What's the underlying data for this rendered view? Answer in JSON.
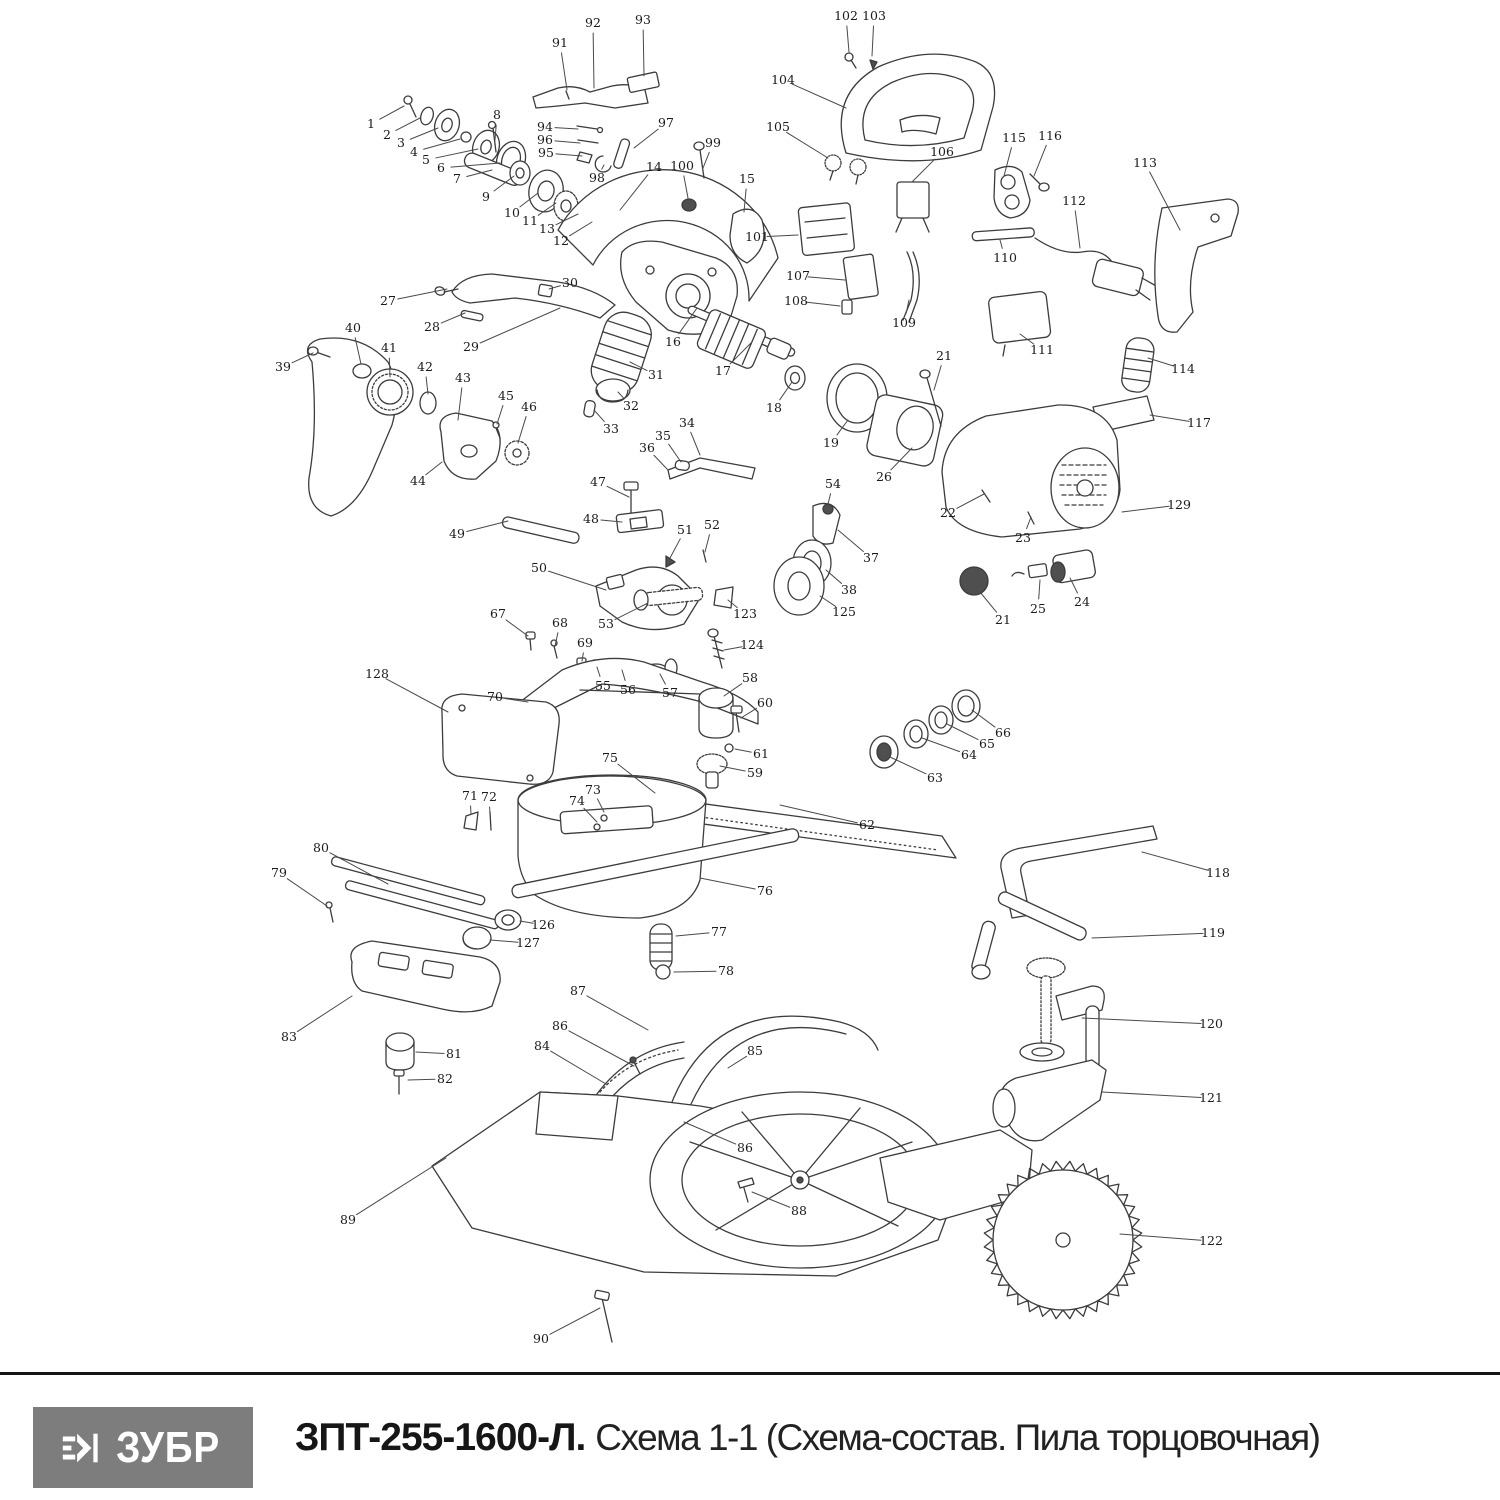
{
  "footer": {
    "logo_text": "ЗУБР",
    "title_bold": "ЗПТ-255-1600-Л.",
    "title_regular": "Схема 1-1 (Схема-состав. Пила торцовочная)"
  },
  "colors": {
    "logo_bg": "#7d7d7d",
    "line": "#3c3c3c",
    "label": "#1b1b1b"
  },
  "diagram": {
    "description": "Exploded-view parts schematic of a miter saw, numbered part labels with leader lines",
    "parts": [
      {
        "n": "1",
        "x": 371,
        "y": 124,
        "tx": 404,
        "ty": 106
      },
      {
        "n": "2",
        "x": 387,
        "y": 135,
        "tx": 420,
        "ty": 118
      },
      {
        "n": "3",
        "x": 401,
        "y": 143,
        "tx": 438,
        "ty": 128
      },
      {
        "n": "4",
        "x": 414,
        "y": 152,
        "tx": 460,
        "ty": 139
      },
      {
        "n": "5",
        "x": 426,
        "y": 160,
        "tx": 478,
        "ty": 149
      },
      {
        "n": "6",
        "x": 441,
        "y": 168,
        "tx": 500,
        "ty": 163
      },
      {
        "n": "7",
        "x": 457,
        "y": 179,
        "tx": 492,
        "ty": 170
      },
      {
        "n": "8",
        "x": 497,
        "y": 115,
        "tx": 495,
        "ty": 140
      },
      {
        "n": "9",
        "x": 486,
        "y": 197,
        "tx": 514,
        "ty": 176
      },
      {
        "n": "10",
        "x": 512,
        "y": 213,
        "tx": 538,
        "ty": 193
      },
      {
        "n": "11",
        "x": 530,
        "y": 221,
        "tx": 556,
        "ty": 203
      },
      {
        "n": "13",
        "x": 547,
        "y": 229,
        "tx": 578,
        "ty": 214
      },
      {
        "n": "12",
        "x": 561,
        "y": 241,
        "tx": 592,
        "ty": 222
      },
      {
        "n": "14",
        "x": 654,
        "y": 167,
        "tx": 620,
        "ty": 210
      },
      {
        "n": "15",
        "x": 747,
        "y": 179,
        "tx": 744,
        "ty": 212
      },
      {
        "n": "16",
        "x": 673,
        "y": 342,
        "tx": 697,
        "ty": 308
      },
      {
        "n": "17",
        "x": 723,
        "y": 371,
        "tx": 752,
        "ty": 342
      },
      {
        "n": "18",
        "x": 774,
        "y": 408,
        "tx": 792,
        "ty": 382
      },
      {
        "n": "19",
        "x": 831,
        "y": 443,
        "tx": 848,
        "ty": 420
      },
      {
        "n": "21",
        "x": 944,
        "y": 356,
        "tx": 934,
        "ty": 390
      },
      {
        "n": "26",
        "x": 884,
        "y": 477,
        "tx": 912,
        "ty": 448
      },
      {
        "n": "22",
        "x": 948,
        "y": 513,
        "tx": 984,
        "ty": 494
      },
      {
        "n": "23",
        "x": 1023,
        "y": 538,
        "tx": 1031,
        "ty": 517
      },
      {
        "n": "129",
        "x": 1179,
        "y": 505,
        "tx": 1122,
        "ty": 512
      },
      {
        "n": "21",
        "x": 1003,
        "y": 620,
        "tx": 980,
        "ty": 592
      },
      {
        "n": "25",
        "x": 1038,
        "y": 609,
        "tx": 1040,
        "ty": 580
      },
      {
        "n": "24",
        "x": 1082,
        "y": 602,
        "tx": 1070,
        "ty": 578
      },
      {
        "n": "37",
        "x": 871,
        "y": 558,
        "tx": 838,
        "ty": 530
      },
      {
        "n": "38",
        "x": 849,
        "y": 590,
        "tx": 826,
        "ty": 570
      },
      {
        "n": "125",
        "x": 844,
        "y": 612,
        "tx": 820,
        "ty": 596
      },
      {
        "n": "123",
        "x": 745,
        "y": 614,
        "tx": 728,
        "ty": 600
      },
      {
        "n": "124",
        "x": 752,
        "y": 645,
        "tx": 724,
        "ty": 650
      },
      {
        "n": "54",
        "x": 833,
        "y": 484,
        "tx": 828,
        "ty": 504
      },
      {
        "n": "27",
        "x": 388,
        "y": 301,
        "tx": 447,
        "ty": 289
      },
      {
        "n": "28",
        "x": 432,
        "y": 327,
        "tx": 465,
        "ty": 313
      },
      {
        "n": "29",
        "x": 471,
        "y": 347,
        "tx": 560,
        "ty": 308
      },
      {
        "n": "30",
        "x": 570,
        "y": 283,
        "tx": 549,
        "ty": 289
      },
      {
        "n": "39",
        "x": 283,
        "y": 367,
        "tx": 313,
        "ty": 353
      },
      {
        "n": "40",
        "x": 353,
        "y": 328,
        "tx": 361,
        "ty": 364
      },
      {
        "n": "41",
        "x": 389,
        "y": 348,
        "tx": 390,
        "ty": 377
      },
      {
        "n": "42",
        "x": 425,
        "y": 367,
        "tx": 428,
        "ty": 394
      },
      {
        "n": "43",
        "x": 463,
        "y": 378,
        "tx": 458,
        "ty": 420
      },
      {
        "n": "45",
        "x": 506,
        "y": 396,
        "tx": 497,
        "ty": 424
      },
      {
        "n": "46",
        "x": 529,
        "y": 407,
        "tx": 518,
        "ty": 443
      },
      {
        "n": "44",
        "x": 418,
        "y": 481,
        "tx": 442,
        "ty": 462
      },
      {
        "n": "31",
        "x": 656,
        "y": 375,
        "tx": 630,
        "ty": 362
      },
      {
        "n": "32",
        "x": 631,
        "y": 406,
        "tx": 618,
        "ty": 392
      },
      {
        "n": "33",
        "x": 611,
        "y": 429,
        "tx": 594,
        "ty": 410
      },
      {
        "n": "34",
        "x": 687,
        "y": 423,
        "tx": 700,
        "ty": 455
      },
      {
        "n": "35",
        "x": 663,
        "y": 436,
        "tx": 681,
        "ty": 462
      },
      {
        "n": "36",
        "x": 647,
        "y": 448,
        "tx": 668,
        "ty": 470
      },
      {
        "n": "47",
        "x": 598,
        "y": 482,
        "tx": 629,
        "ty": 497
      },
      {
        "n": "48",
        "x": 591,
        "y": 519,
        "tx": 622,
        "ty": 522
      },
      {
        "n": "49",
        "x": 457,
        "y": 534,
        "tx": 508,
        "ty": 521
      },
      {
        "n": "50",
        "x": 539,
        "y": 568,
        "tx": 606,
        "ty": 590
      },
      {
        "n": "51",
        "x": 685,
        "y": 530,
        "tx": 670,
        "ty": 558
      },
      {
        "n": "52",
        "x": 712,
        "y": 525,
        "tx": 705,
        "ty": 552
      },
      {
        "n": "53",
        "x": 606,
        "y": 624,
        "tx": 648,
        "ty": 603
      },
      {
        "n": "67",
        "x": 498,
        "y": 614,
        "tx": 528,
        "ty": 636
      },
      {
        "n": "68",
        "x": 560,
        "y": 623,
        "tx": 555,
        "ty": 646
      },
      {
        "n": "69",
        "x": 585,
        "y": 643,
        "tx": 582,
        "ty": 661
      },
      {
        "n": "55",
        "x": 603,
        "y": 686,
        "tx": 597,
        "ty": 667
      },
      {
        "n": "56",
        "x": 628,
        "y": 690,
        "tx": 622,
        "ty": 670
      },
      {
        "n": "57",
        "x": 670,
        "y": 693,
        "tx": 660,
        "ty": 674
      },
      {
        "n": "128",
        "x": 377,
        "y": 674,
        "tx": 448,
        "ty": 712
      },
      {
        "n": "70",
        "x": 495,
        "y": 697,
        "tx": 528,
        "ty": 702
      },
      {
        "n": "58",
        "x": 750,
        "y": 678,
        "tx": 724,
        "ty": 696
      },
      {
        "n": "60",
        "x": 765,
        "y": 703,
        "tx": 741,
        "ty": 718
      },
      {
        "n": "61",
        "x": 761,
        "y": 754,
        "tx": 735,
        "ty": 749
      },
      {
        "n": "59",
        "x": 755,
        "y": 773,
        "tx": 720,
        "ty": 766
      },
      {
        "n": "75",
        "x": 610,
        "y": 758,
        "tx": 655,
        "ty": 793
      },
      {
        "n": "71",
        "x": 470,
        "y": 796,
        "tx": 471,
        "ty": 814
      },
      {
        "n": "72",
        "x": 489,
        "y": 797,
        "tx": 490,
        "ty": 814
      },
      {
        "n": "73",
        "x": 593,
        "y": 790,
        "tx": 604,
        "ty": 812
      },
      {
        "n": "74",
        "x": 577,
        "y": 801,
        "tx": 597,
        "ty": 822
      },
      {
        "n": "76",
        "x": 765,
        "y": 891,
        "tx": 700,
        "ty": 878
      },
      {
        "n": "62",
        "x": 867,
        "y": 825,
        "tx": 780,
        "ty": 805
      },
      {
        "n": "63",
        "x": 935,
        "y": 778,
        "tx": 890,
        "ty": 757
      },
      {
        "n": "64",
        "x": 969,
        "y": 755,
        "tx": 922,
        "ty": 738
      },
      {
        "n": "65",
        "x": 987,
        "y": 744,
        "tx": 947,
        "ty": 724
      },
      {
        "n": "66",
        "x": 1003,
        "y": 733,
        "tx": 972,
        "ty": 710
      },
      {
        "n": "118",
        "x": 1218,
        "y": 873,
        "tx": 1142,
        "ty": 852
      },
      {
        "n": "119",
        "x": 1213,
        "y": 933,
        "tx": 1092,
        "ty": 938
      },
      {
        "n": "120",
        "x": 1211,
        "y": 1024,
        "tx": 1082,
        "ty": 1018
      },
      {
        "n": "121",
        "x": 1211,
        "y": 1098,
        "tx": 1102,
        "ty": 1092
      },
      {
        "n": "122",
        "x": 1211,
        "y": 1241,
        "tx": 1120,
        "ty": 1234
      },
      {
        "n": "77",
        "x": 719,
        "y": 932,
        "tx": 676,
        "ty": 936
      },
      {
        "n": "78",
        "x": 726,
        "y": 971,
        "tx": 674,
        "ty": 972
      },
      {
        "n": "87",
        "x": 578,
        "y": 991,
        "tx": 648,
        "ty": 1030
      },
      {
        "n": "86",
        "x": 560,
        "y": 1026,
        "tx": 634,
        "ty": 1066
      },
      {
        "n": "84",
        "x": 542,
        "y": 1046,
        "tx": 606,
        "ty": 1084
      },
      {
        "n": "85",
        "x": 755,
        "y": 1051,
        "tx": 728,
        "ty": 1068
      },
      {
        "n": "86",
        "x": 745,
        "y": 1148,
        "tx": 684,
        "ty": 1122
      },
      {
        "n": "88",
        "x": 799,
        "y": 1211,
        "tx": 752,
        "ty": 1192
      },
      {
        "n": "79",
        "x": 279,
        "y": 873,
        "tx": 327,
        "ty": 906
      },
      {
        "n": "80",
        "x": 321,
        "y": 848,
        "tx": 388,
        "ty": 884
      },
      {
        "n": "83",
        "x": 289,
        "y": 1037,
        "tx": 352,
        "ty": 996
      },
      {
        "n": "81",
        "x": 454,
        "y": 1054,
        "tx": 416,
        "ty": 1052
      },
      {
        "n": "82",
        "x": 445,
        "y": 1079,
        "tx": 408,
        "ty": 1080
      },
      {
        "n": "126",
        "x": 543,
        "y": 925,
        "tx": 520,
        "ty": 921
      },
      {
        "n": "127",
        "x": 528,
        "y": 943,
        "tx": 490,
        "ty": 940
      },
      {
        "n": "89",
        "x": 348,
        "y": 1220,
        "tx": 446,
        "ty": 1158
      },
      {
        "n": "90",
        "x": 541,
        "y": 1339,
        "tx": 600,
        "ty": 1308
      },
      {
        "n": "91",
        "x": 560,
        "y": 43,
        "tx": 567,
        "ty": 90
      },
      {
        "n": "92",
        "x": 593,
        "y": 23,
        "tx": 594,
        "ty": 88
      },
      {
        "n": "93",
        "x": 643,
        "y": 20,
        "tx": 644,
        "ty": 76
      },
      {
        "n": "94",
        "x": 545,
        "y": 127,
        "tx": 578,
        "ty": 129
      },
      {
        "n": "96",
        "x": 545,
        "y": 140,
        "tx": 580,
        "ty": 143
      },
      {
        "n": "95",
        "x": 546,
        "y": 153,
        "tx": 582,
        "ty": 156
      },
      {
        "n": "97",
        "x": 666,
        "y": 123,
        "tx": 634,
        "ty": 148
      },
      {
        "n": "98",
        "x": 597,
        "y": 178,
        "tx": 604,
        "ty": 165
      },
      {
        "n": "99",
        "x": 713,
        "y": 143,
        "tx": 703,
        "ty": 168
      },
      {
        "n": "100",
        "x": 682,
        "y": 166,
        "tx": 688,
        "ty": 198
      },
      {
        "n": "102",
        "x": 846,
        "y": 16,
        "tx": 849,
        "ty": 52
      },
      {
        "n": "103",
        "x": 874,
        "y": 16,
        "tx": 872,
        "ty": 56
      },
      {
        "n": "104",
        "x": 783,
        "y": 80,
        "tx": 846,
        "ty": 108
      },
      {
        "n": "105",
        "x": 778,
        "y": 127,
        "tx": 828,
        "ty": 158
      },
      {
        "n": "106",
        "x": 942,
        "y": 152,
        "tx": 912,
        "ty": 182
      },
      {
        "n": "101",
        "x": 757,
        "y": 237,
        "tx": 798,
        "ty": 235
      },
      {
        "n": "107",
        "x": 798,
        "y": 276,
        "tx": 845,
        "ty": 280
      },
      {
        "n": "108",
        "x": 796,
        "y": 301,
        "tx": 840,
        "ty": 306
      },
      {
        "n": "109",
        "x": 904,
        "y": 323,
        "tx": 909,
        "ty": 300
      },
      {
        "n": "110",
        "x": 1005,
        "y": 258,
        "tx": 1000,
        "ty": 240
      },
      {
        "n": "111",
        "x": 1042,
        "y": 350,
        "tx": 1020,
        "ty": 334
      },
      {
        "n": "112",
        "x": 1074,
        "y": 201,
        "tx": 1080,
        "ty": 248
      },
      {
        "n": "113",
        "x": 1145,
        "y": 163,
        "tx": 1180,
        "ty": 230
      },
      {
        "n": "114",
        "x": 1183,
        "y": 369,
        "tx": 1148,
        "ty": 358
      },
      {
        "n": "115",
        "x": 1014,
        "y": 138,
        "tx": 1004,
        "ty": 176
      },
      {
        "n": "116",
        "x": 1050,
        "y": 136,
        "tx": 1034,
        "ty": 176
      },
      {
        "n": "117",
        "x": 1199,
        "y": 423,
        "tx": 1150,
        "ty": 415
      }
    ]
  }
}
